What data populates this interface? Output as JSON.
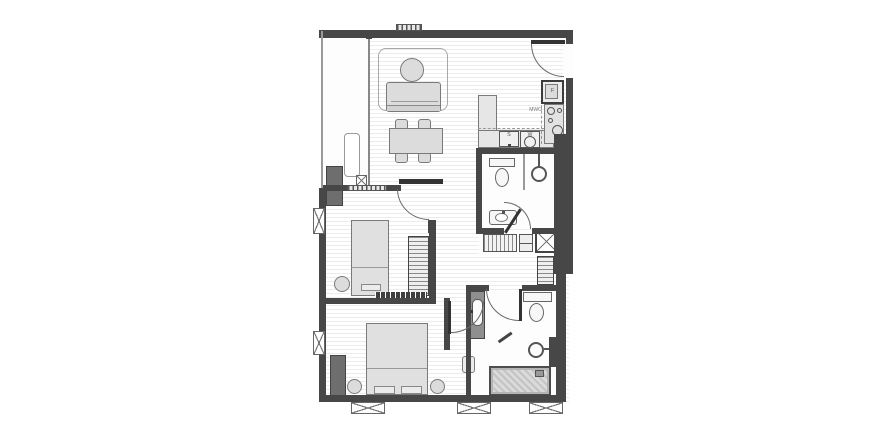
{
  "labels": {
    "fridge": "F",
    "sink": "S",
    "washer": "W",
    "microwave": "MWO"
  },
  "colors": {
    "wall": "#474747",
    "furniture_fill": "#dcdcdc",
    "furniture_border": "#7a7a7a",
    "floor_stripe": "#ececec",
    "dark_unit": "#6e6e6e",
    "door": "#333333",
    "background": "#ffffff"
  }
}
